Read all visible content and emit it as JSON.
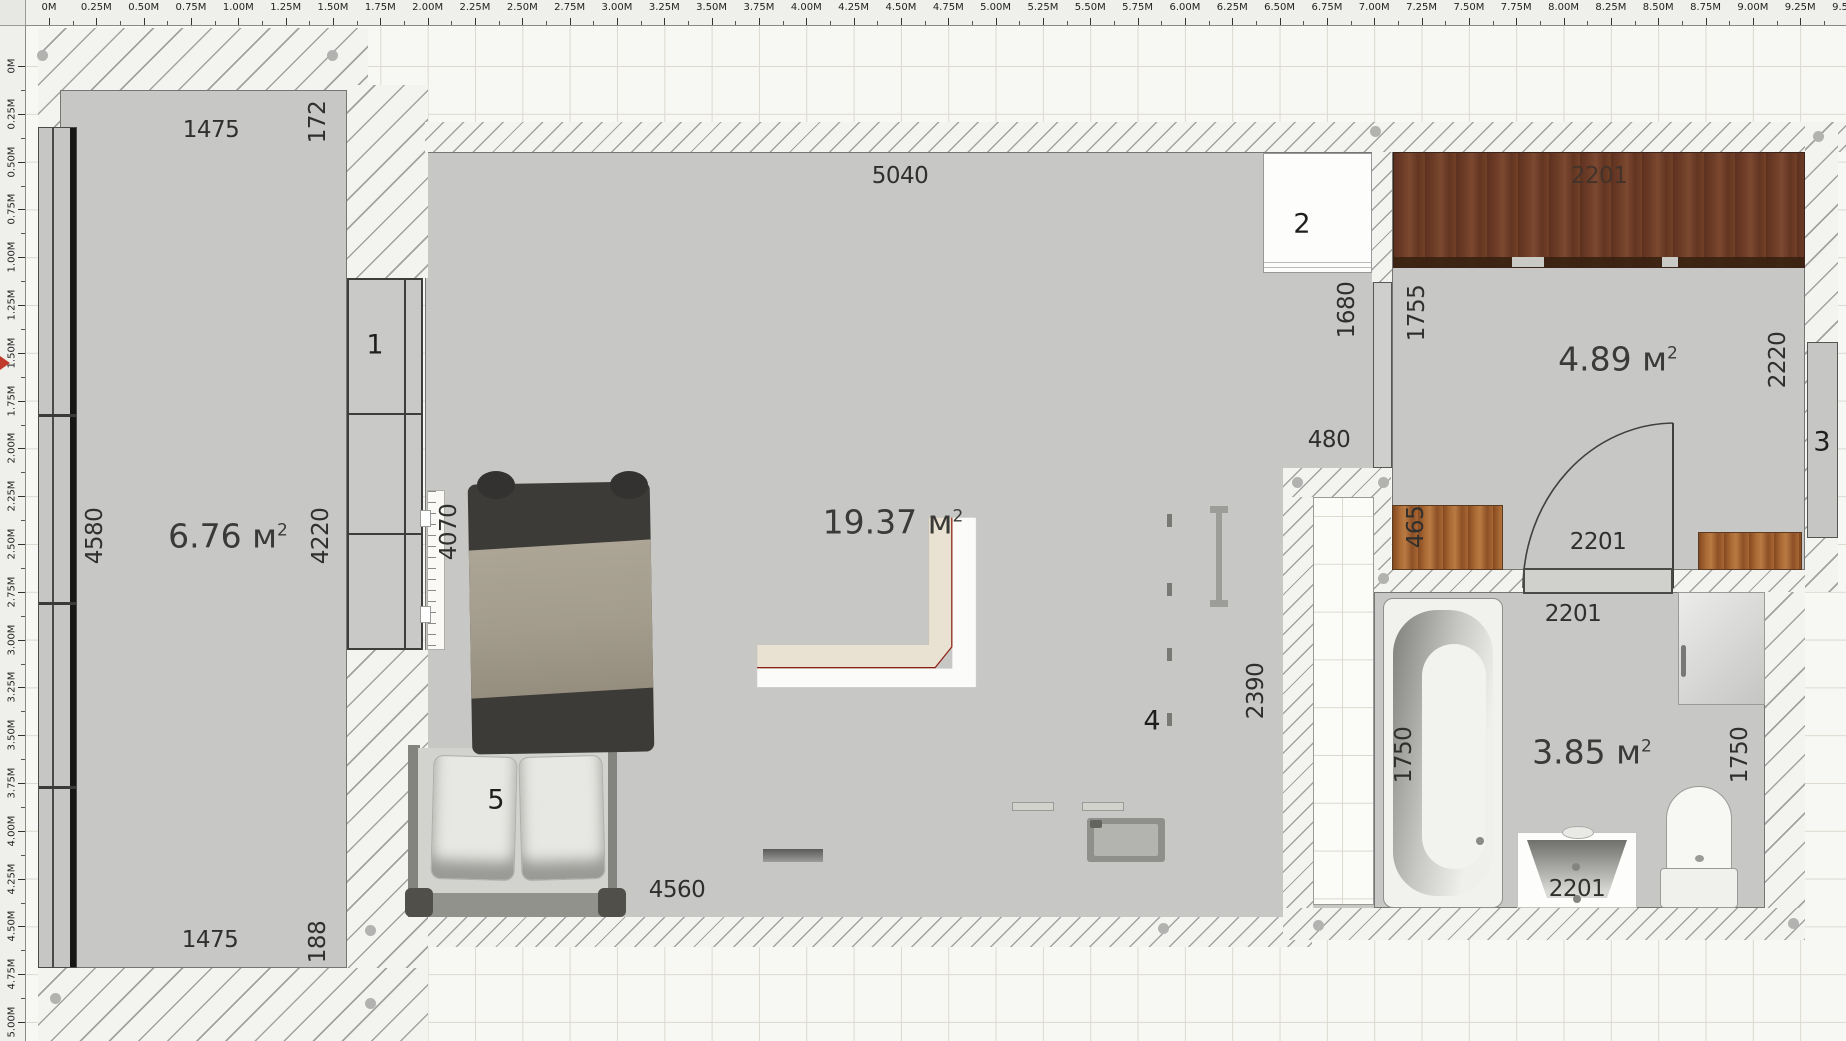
{
  "rulers": {
    "top": [
      "0M",
      "0.25M",
      "0.50M",
      "0.75M",
      "1.00M",
      "1.25M",
      "1.50M",
      "1.75M",
      "2.00M",
      "2.25M",
      "2.50M",
      "2.75M",
      "3.00M",
      "3.25M",
      "3.50M",
      "3.75M",
      "4.00M",
      "4.25M",
      "4.50M",
      "4.75M",
      "5.00M",
      "5.25M",
      "5.50M",
      "5.75M",
      "6.00M",
      "6.25M",
      "6.50M",
      "6.75M",
      "7.00M",
      "7.25M",
      "7.50M",
      "7.75M",
      "8.00M",
      "8.25M",
      "8.50M",
      "8.75M",
      "9.00M",
      "9.25M",
      "9.50M"
    ],
    "left": [
      "0M",
      "0.25M",
      "0.50M",
      "0.75M",
      "1.00M",
      "1.25M",
      "1.50M",
      "1.75M",
      "2.00M",
      "2.25M",
      "2.50M",
      "2.75M",
      "3.00M",
      "3.25M",
      "3.50M",
      "3.75M",
      "4.00M",
      "4.25M",
      "4.50M",
      "4.75M",
      "5.00M"
    ]
  },
  "areas": {
    "balcony": {
      "v": "6.76 м",
      "s": "2"
    },
    "living": {
      "v": "19.37 м",
      "s": "2"
    },
    "hall": {
      "v": "4.89 м",
      "s": "2"
    },
    "bath": {
      "v": "3.85 м",
      "s": "2"
    }
  },
  "dims": {
    "balcony_top": "1475",
    "balcony_top_right": "172",
    "balcony_left": "4580",
    "balcony_right": "4220",
    "balcony_bottom": "1475",
    "balcony_bottom_right": "188",
    "living_top": "5040",
    "living_left": "4070",
    "living_bottom": "4560",
    "kitchen_side": "2390",
    "opening": "480",
    "partition_left": "1680",
    "partition_right": "1755",
    "hall_right": "2220",
    "hall_cabinet": "465",
    "wardrobe_code": "2201",
    "hall_door_code": "2201",
    "bath_door_code": "2201",
    "tub": "1750",
    "bath_right": "1750",
    "sink_code": "2201"
  },
  "markers": {
    "balcony_window": "1",
    "fridge": "2",
    "right_window": "3",
    "kitchen": "4",
    "bed": "5"
  }
}
